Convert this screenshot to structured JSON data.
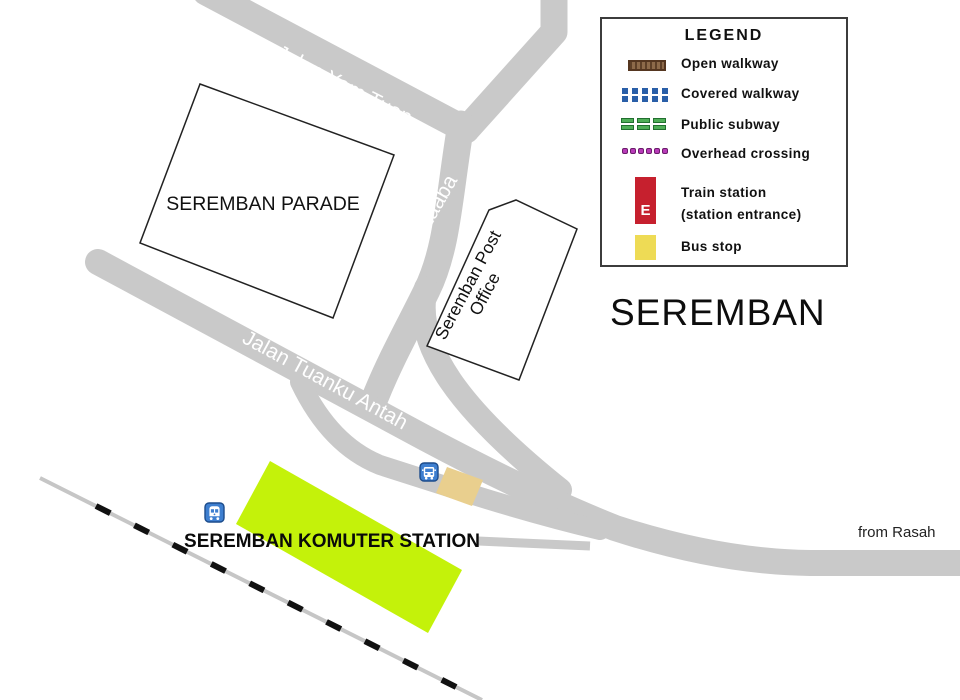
{
  "map": {
    "title": "SEREMBAN",
    "from_label": "from Rasah",
    "roads": [
      {
        "name": "Jalan Yam Tuan"
      },
      {
        "name": "Jalan Zaaba"
      },
      {
        "name": "Jalan Tuanku Antah"
      }
    ],
    "buildings": {
      "parade": "SEREMBAN PARADE",
      "post_office_line1": "Seremban Post",
      "post_office_line2": "Office",
      "komuter_station": "SEREMBAN KOMUTER STATION"
    },
    "icons": {
      "train": "train-icon",
      "bus": "bus-icon"
    },
    "colors": {
      "road_gray": "#c9c9c9",
      "railway_gray": "#c6c6c6",
      "railway_dash_black": "#111111",
      "station_green": "#c4f20a",
      "bus_stop_tan": "#e9cf8e",
      "icon_blue": "#3e7fd0",
      "icon_border_blue": "#1c4c8c"
    }
  },
  "legend": {
    "title": "LEGEND",
    "open_walkway": "Open walkway",
    "covered_walkway": "Covered walkway",
    "public_subway": "Public subway",
    "overhead_crossing": "Overhead crossing",
    "train_station_line1": "Train station",
    "train_station_line2": "(station entrance)",
    "train_entrance_letter": "E",
    "bus_stop": "Bus stop",
    "colors": {
      "open_walkway_brown": "#8d6a4a",
      "covered_walkway_blue": "#2a5fa8",
      "public_subway_green": "#4fae57",
      "overhead_crossing_purple": "#b83bb8",
      "train_station_red": "#c6202e",
      "bus_stop_yellow": "#eedb55"
    }
  }
}
